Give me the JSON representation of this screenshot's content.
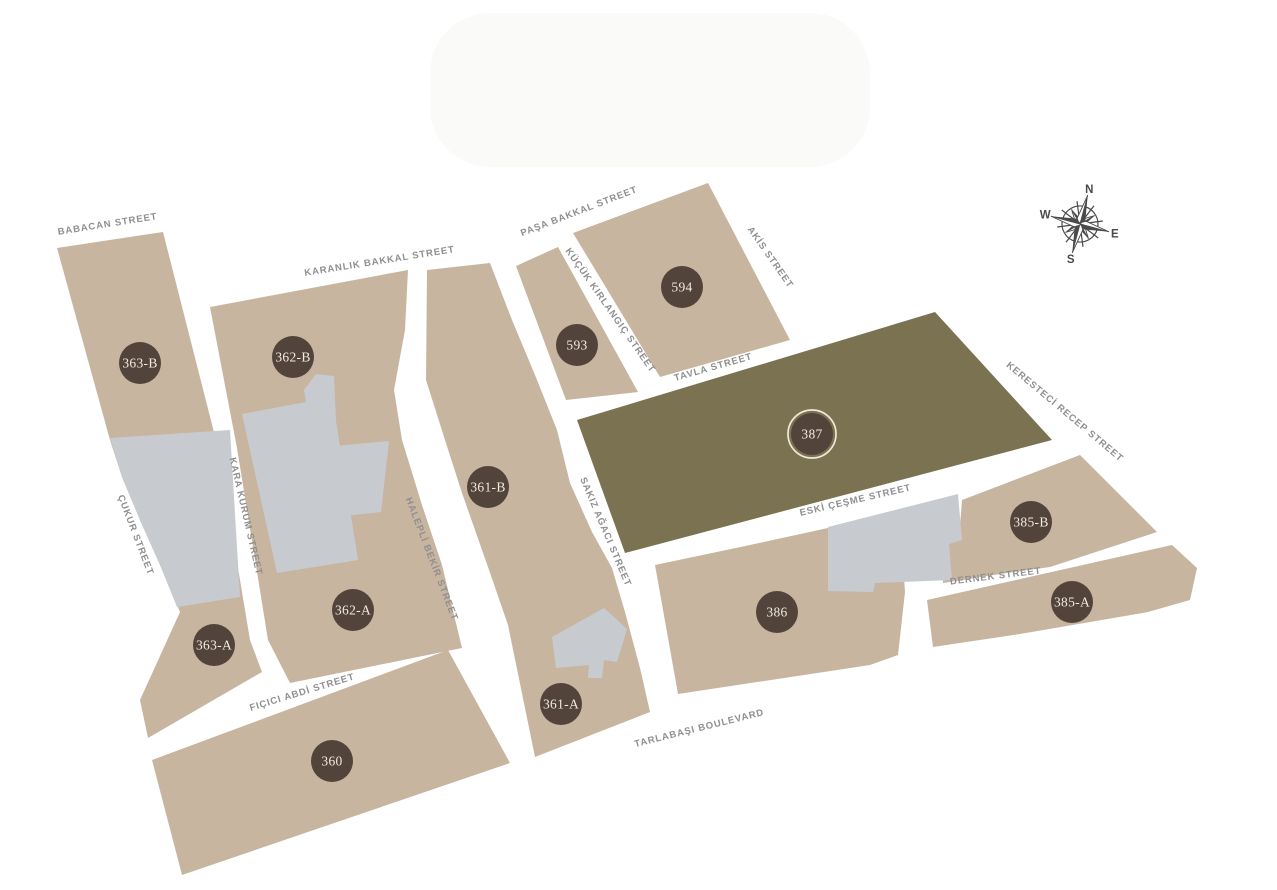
{
  "theme": {
    "bg": "#ffffff",
    "parcel": "#c7b5a0",
    "parcel-olive": "#7a7250",
    "building": "#c7cbcf",
    "marker": "#53443b",
    "marker-ring": "#f1e9d8",
    "marker-text": "#f1eadf",
    "street-text": "#8f8f8f",
    "compass": "#4a4a4a"
  },
  "markers": [
    {
      "label": "363-B"
    },
    {
      "label": "362-B"
    },
    {
      "label": "593"
    },
    {
      "label": "594"
    },
    {
      "label": "387",
      "highlighted": true
    },
    {
      "label": "361-B"
    },
    {
      "label": "362-A"
    },
    {
      "label": "363-A"
    },
    {
      "label": "360"
    },
    {
      "label": "361-A"
    },
    {
      "label": "386"
    },
    {
      "label": "385-B"
    },
    {
      "label": "385-A"
    }
  ],
  "streets": [
    {
      "name": "BABACAN STREET"
    },
    {
      "name": "KARANLIK BAKKAL STREET"
    },
    {
      "name": "PAŞA BAKKAL STREET"
    },
    {
      "name": "KÜÇÜK KIRLANGIÇ STREET"
    },
    {
      "name": "AKİS STREET"
    },
    {
      "name": "TAVLA STREET"
    },
    {
      "name": "KERESTECİ RECEP STREET"
    },
    {
      "name": "ÇUKUR STREET"
    },
    {
      "name": "KARA KURUM STREET"
    },
    {
      "name": "HALEPLİ BEKİR STREET"
    },
    {
      "name": "SAKIZ AĞACI STREET"
    },
    {
      "name": "ESKİ ÇEŞME STREET"
    },
    {
      "name": "DERNEK STREET"
    },
    {
      "name": "FIÇICI ABDİ STREET"
    },
    {
      "name": "TARLABAŞI BOULEVARD"
    }
  ],
  "compass": {
    "north": "N",
    "east": "E",
    "south": "S",
    "west": "W"
  }
}
